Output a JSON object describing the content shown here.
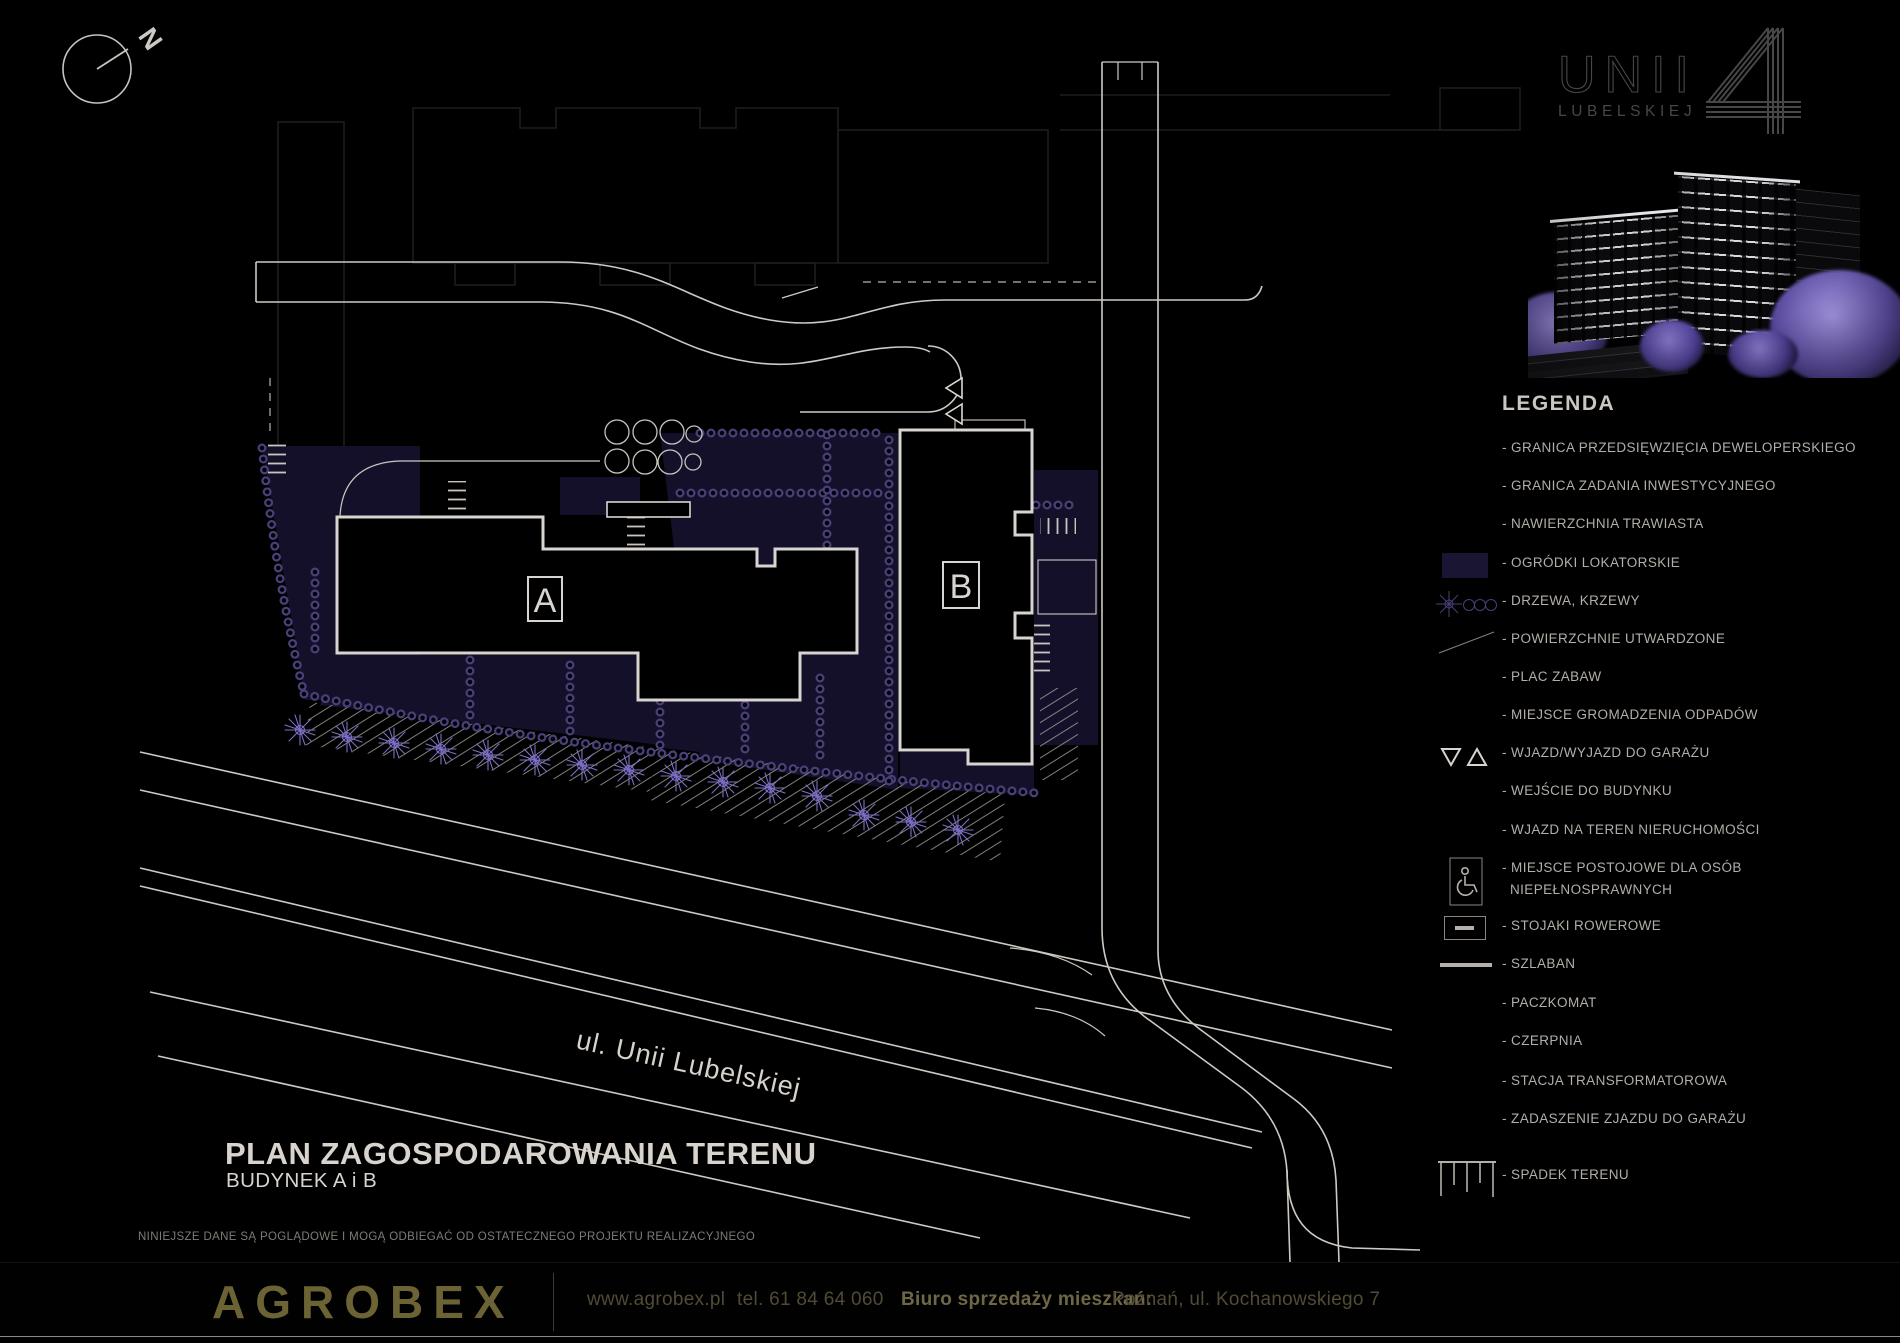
{
  "compass": {
    "label": "N"
  },
  "logo": {
    "line1": "UNII",
    "line2": "LUBELSKIEJ",
    "numeral": "4"
  },
  "render_caption": "building-render",
  "legend": {
    "heading": "LEGENDA",
    "items": [
      {
        "label": "- GRANICA PRZEDSIĘWZIĘCIA DEWELOPERSKIEGO",
        "icon": "none"
      },
      {
        "label": "- GRANICA ZADANIA INWESTYCYJNEGO",
        "icon": "none"
      },
      {
        "label": "- NAWIERZCHNIA TRAWIASTA",
        "icon": "none"
      },
      {
        "label": "- OGRÓDKI LOKATORSKIE",
        "icon": "garden-swatch"
      },
      {
        "label": "- DRZEWA, KRZEWY",
        "icon": "trees"
      },
      {
        "label": "- POWIERZCHNIE UTWARDZONE",
        "icon": "paved-line"
      },
      {
        "label": "- PLAC ZABAW",
        "icon": "none"
      },
      {
        "label": "- MIEJSCE GROMADZENIA ODPADÓW",
        "icon": "none"
      },
      {
        "label": "- WJAZD/WYJAZD DO GARAŻU",
        "icon": "garage-triangles"
      },
      {
        "label": "- WEJŚCIE DO BUDYNKU",
        "icon": "none"
      },
      {
        "label": "- WJAZD NA TEREN NIERUCHOMOŚCI",
        "icon": "none"
      },
      {
        "label": "- MIEJSCE POSTOJOWE DLA OSÓB",
        "label2": "NIEPEŁNOSPRAWNYCH",
        "icon": "disabled-parking"
      },
      {
        "label": "- STOJAKI ROWEROWE",
        "icon": "bike-rack"
      },
      {
        "label": "- SZLABAN",
        "icon": "barrier-line"
      },
      {
        "label": "- PACZKOMAT",
        "icon": "none"
      },
      {
        "label": "- CZERPNIA",
        "icon": "none"
      },
      {
        "label": "- STACJA TRANSFORMATOROWA",
        "icon": "none"
      },
      {
        "label": "- ZADASZENIE ZJAZDU DO GARAŻU",
        "icon": "none"
      },
      {
        "label": "- SPADEK TERENU",
        "icon": "slope-comb"
      }
    ]
  },
  "plan": {
    "building_a_label": "A",
    "building_b_label": "B",
    "street_label": "ul. Unii Lubelskiej"
  },
  "title_block": {
    "title": "PLAN ZAGOSPODAROWANIA TERENU",
    "subtitle": "BUDYNEK A i B",
    "disclaimer": "NINIEJSZE DANE SĄ POGLĄDOWE I MOGĄ ODBIEGAĆ OD OSTATECZNEGO PROJEKTU REALIZACYJNEGO"
  },
  "footer": {
    "brand": "AGROBEX",
    "website": "www.agrobex.pl",
    "phone": "tel. 61 84 64 060",
    "office_label": "Biuro sprzedaży mieszkań:",
    "office_address": "Poznań, ul. Kochanowskiego 7"
  },
  "colors": {
    "background": "#000000",
    "plan_line": "#cfc9c3",
    "building_line": "#d9d4cf",
    "faint_building_line": "#1d1d1d",
    "garden_fill": "#14102a",
    "shrub_purple": "#4a3f7a",
    "tree_purple": "#7e6fc6",
    "legend_text": "#b3aea8",
    "brand_gold": "#6b6333",
    "footer_text": "#514b36",
    "logo_gray": "#474747"
  }
}
